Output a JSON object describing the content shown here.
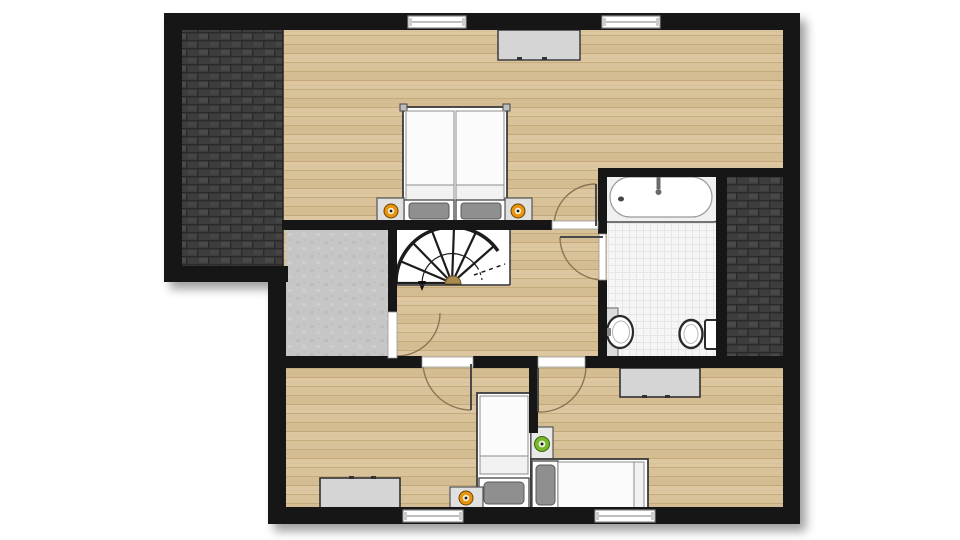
{
  "colors": {
    "background": "#ffffff",
    "wall": "#151515",
    "wood_floor": "#d8c29a",
    "wood_plank_line": "#bfa271",
    "roof_tile": "#3d3d3d",
    "roof_tile_line": "#2a2a2a",
    "roof_tile_highlight": "#484848",
    "concrete_floor": "#c6c6c6",
    "concrete_speckle": "#b9b9b9",
    "bathroom_floor": "#f6f6f6",
    "bathroom_tile_line": "#e6e6e6",
    "stair_floor": "#ffffff",
    "stair_stroke": "#1c1c1c",
    "stair_center": "#a98a50",
    "furniture_fill": "#d5d5d5",
    "furniture_stroke": "#3c3c3c",
    "bed_frame": "#ffffff",
    "duvet": "#fbfbfb",
    "duvet_stroke": "#8c8c8c",
    "pillow": "#8f8f8f",
    "pillow_stroke": "#5a5a5a",
    "lamp_orange": "#e8940f",
    "lamp_green": "#76b82a",
    "lamp_inner": "#f5efdf",
    "lamp_dot": "#1c1c1c",
    "door_swing": "#8a7454",
    "door_leaf": "#4a4a4a",
    "threshold": "#ffffff",
    "threshold_stroke": "#9a9a9a",
    "window_frame": "#8c8c8c",
    "fixture_fill": "#ffffff",
    "fixture_stroke": "#2a2a2a",
    "tub_rim": "#f0f0f0",
    "faucet": "#6b6b6b"
  },
  "inventory": {
    "plan_type": "upper-floor-plan",
    "rooms": [
      "master-bedroom",
      "landing-hallway",
      "storage-room",
      "bathroom",
      "bedroom-2",
      "bedroom-3"
    ],
    "roof_areas": [
      "roof-top-left",
      "roof-right"
    ],
    "stairs": "spiral-winder-staircase",
    "furniture": [
      "double-bed",
      "nightstand-with-orange-lamp",
      "nightstand-with-orange-lamp",
      "dresser-top",
      "bathtub",
      "sink",
      "toilet",
      "dresser-bottom-left",
      "single-bed-vertical",
      "nightstand-with-orange-lamp",
      "nightstand-with-green-lamp",
      "single-bed-horizontal",
      "dresser-bottom-right"
    ],
    "window_count": 4,
    "door_count": 5
  }
}
